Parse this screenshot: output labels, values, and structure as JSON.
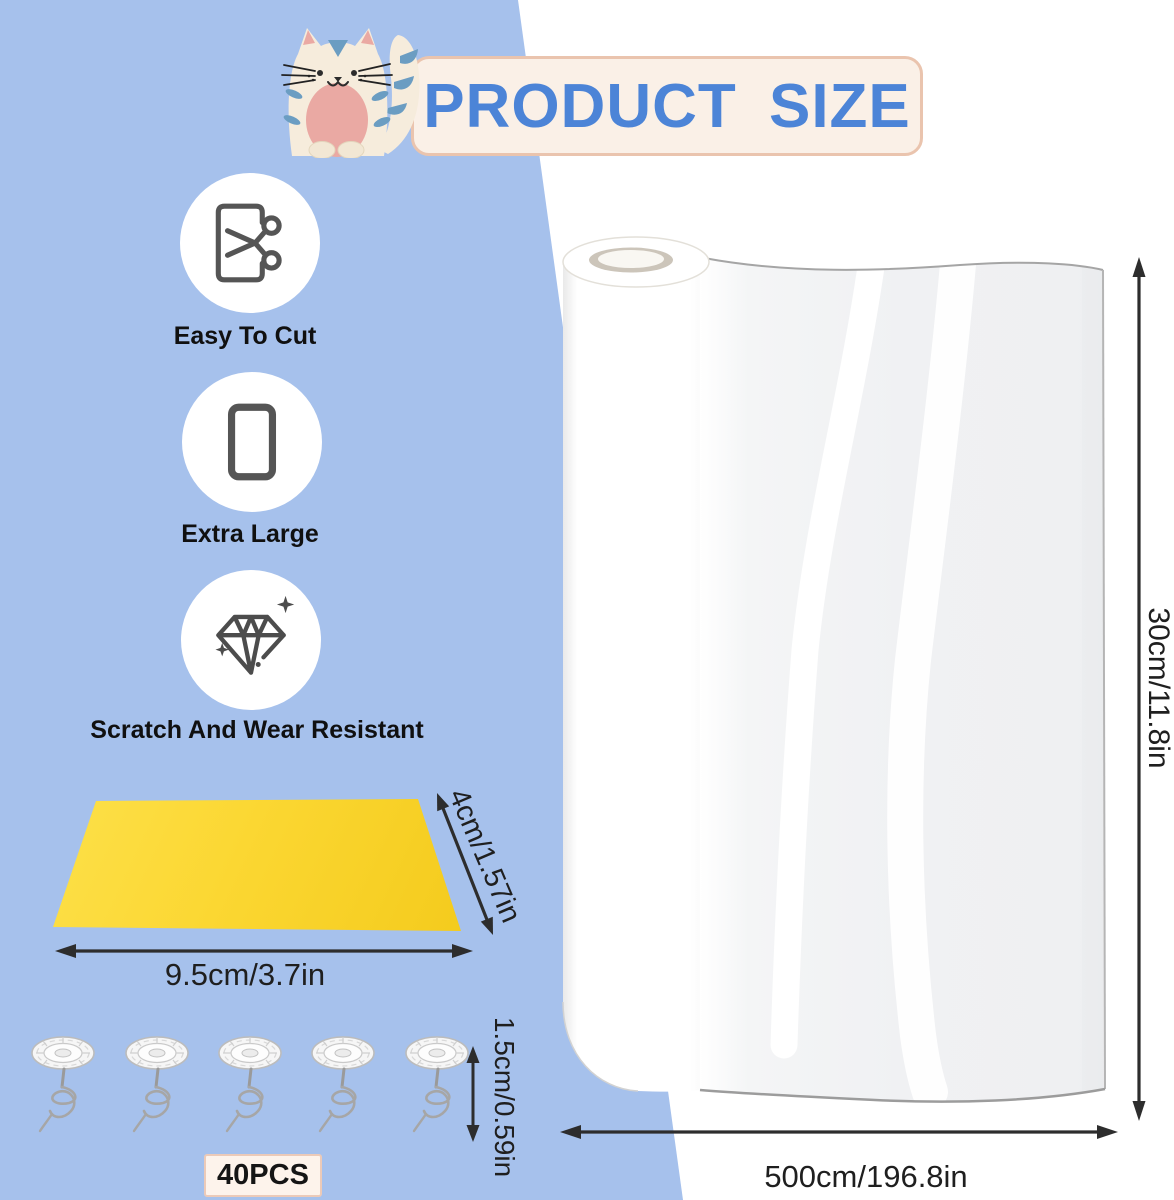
{
  "header": {
    "title": "PRODUCT SIZE",
    "mascot": "cat-icon"
  },
  "features": [
    {
      "label": "Easy To Cut",
      "icon": "scissors-cut-icon"
    },
    {
      "label": "Extra Large",
      "icon": "large-sheet-icon"
    },
    {
      "label": "Scratch And Wear Resistant",
      "icon": "diamond-sparkle-icon"
    }
  ],
  "squeegee": {
    "length_label": "9.5cm/3.7in",
    "width_label": "4cm/1.57in"
  },
  "pins": {
    "height_label": "1.5cm/0.59in",
    "count_label": "40PCS",
    "pins_shown": 5
  },
  "roll": {
    "height_label": "30cm/11.8in",
    "length_label": "500cm/196.8in"
  },
  "colors": {
    "background_blue": "#a6c1ec",
    "banner_fill": "#faf0e7",
    "banner_border": "#eac4ae",
    "title_text": "#4c84d7",
    "squeegee_yellow": "#fbd732",
    "dimension_text": "#1f1f1f",
    "icon_stroke": "#555555"
  }
}
